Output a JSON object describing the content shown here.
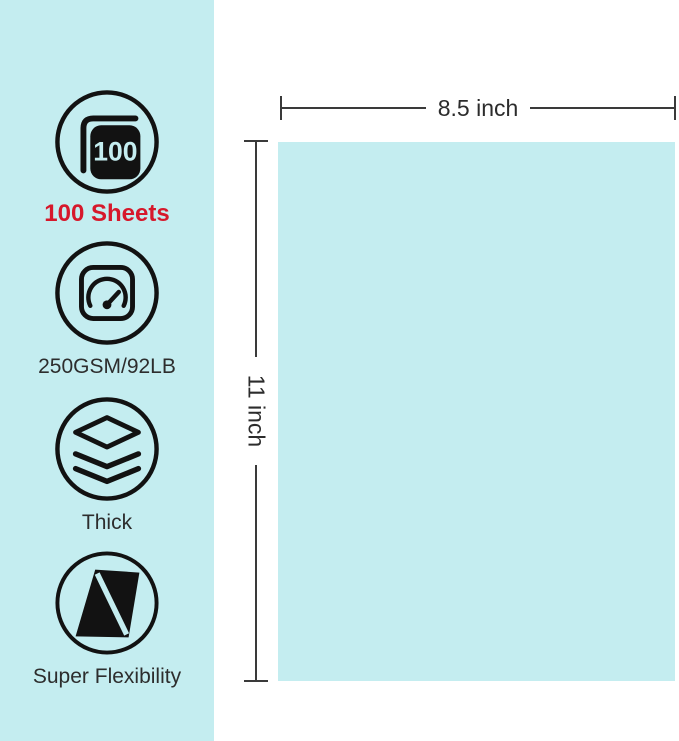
{
  "colors": {
    "panel_bg": "#c4edf0",
    "paper_fill": "#c4edf0",
    "accent_red": "#d6182b",
    "icon_ink": "#121212",
    "dimension_line": "#3a3a3a",
    "text": "#2d2d2d"
  },
  "sidebar": {
    "features": [
      {
        "icon": "sheets-stack-icon",
        "badge": "100",
        "label": "100 Sheets"
      },
      {
        "icon": "gauge-icon",
        "label": "250GSM/92LB"
      },
      {
        "icon": "layers-icon",
        "label": "Thick"
      },
      {
        "icon": "flex-parallelogram-icon",
        "label": "Super Flexibility"
      }
    ]
  },
  "diagram": {
    "width_label": "8.5 inch",
    "height_label": "11 inch"
  }
}
